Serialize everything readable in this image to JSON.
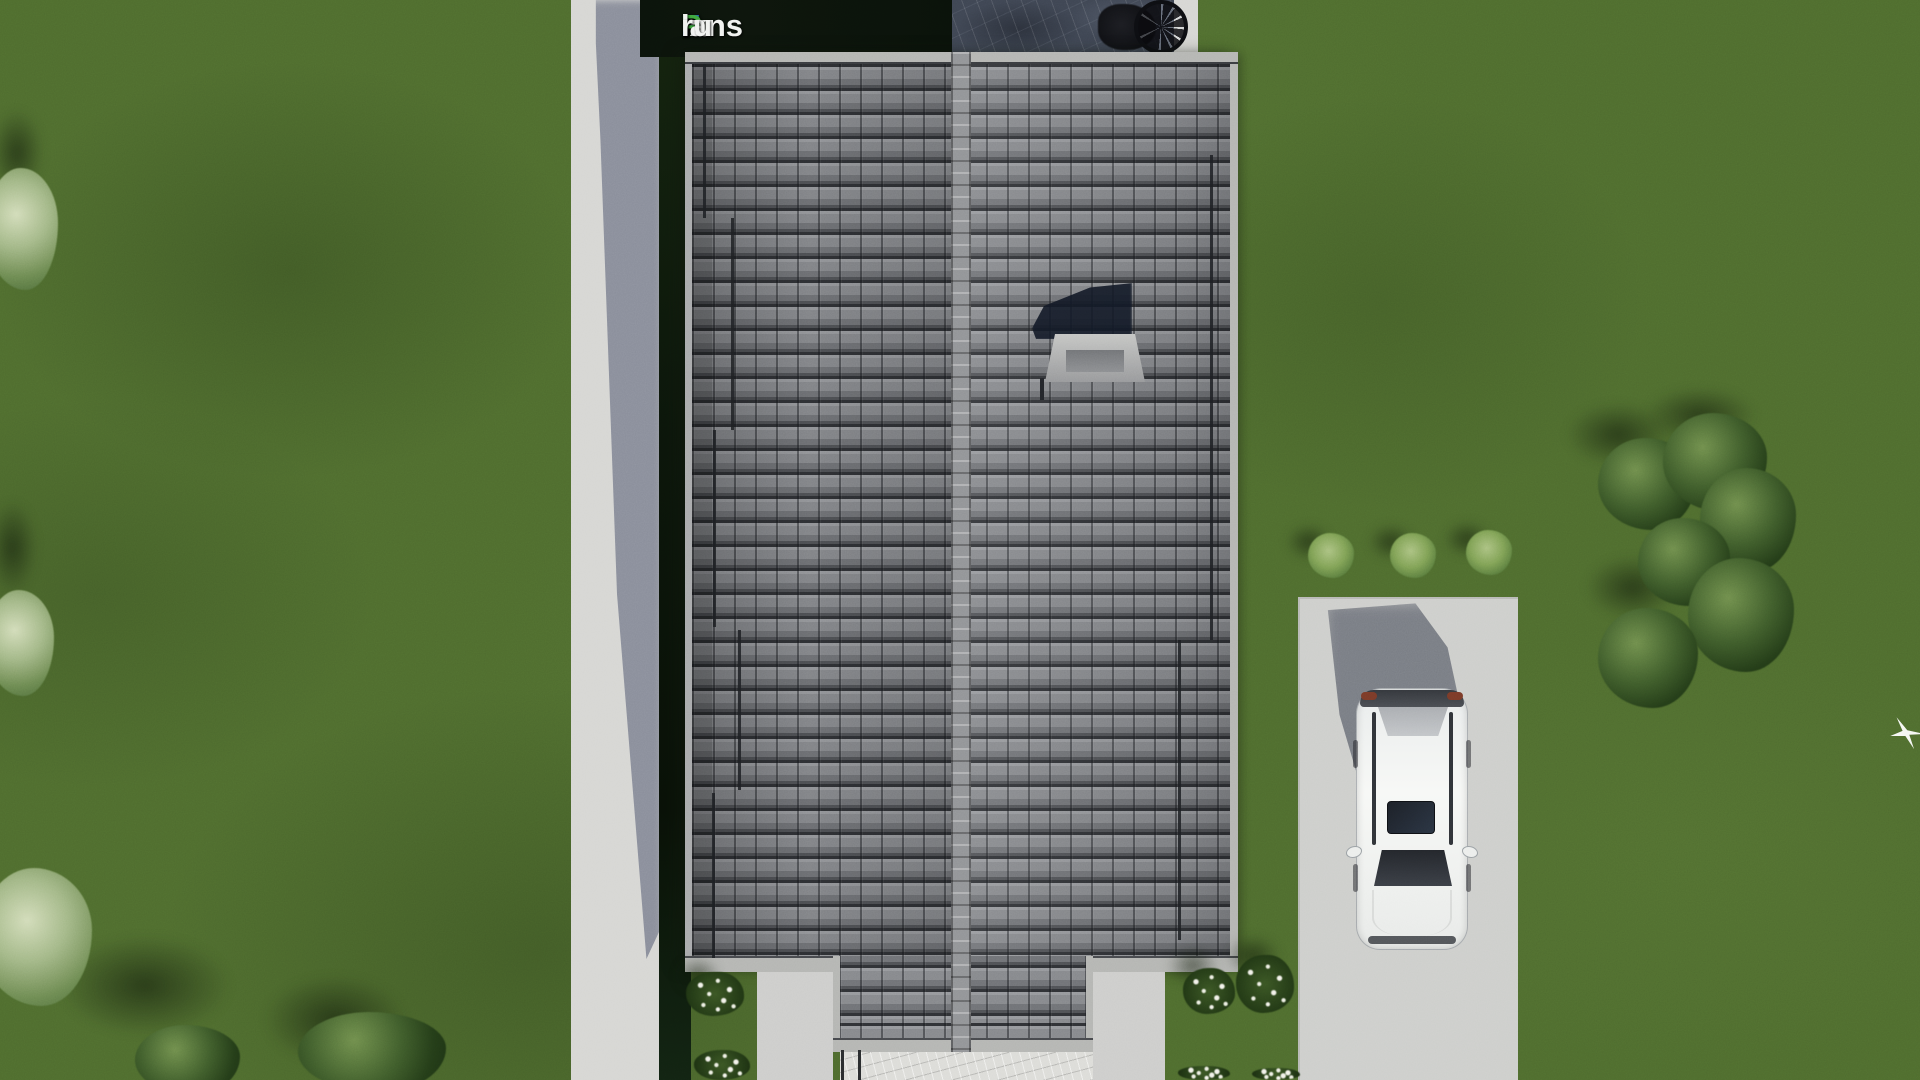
{
  "watermark": {
    "text": "FixPlans.ru",
    "segments": [
      {
        "text": "F",
        "color": "#2e6fd8"
      },
      {
        "text": "ix",
        "color": "#f1f2f0"
      },
      {
        "text": "P",
        "color": "#3da83d"
      },
      {
        "text": "lans",
        "color": "#f1f2f0"
      },
      {
        "text": ".",
        "color": "#2e6fd8"
      },
      {
        "text": "ru",
        "color": "#f1f2f0"
      }
    ]
  },
  "colors": {
    "grass": "#4e6b2e",
    "path": "#d6d6d3",
    "driveway": "#cdcecb",
    "walkway": "#dcdcd8",
    "roof_tile": "#828487",
    "roof_gap": "#2f3135",
    "roof_ridge": "#919396",
    "fascia": "#b4b5b2",
    "hedge": "#101d0e",
    "logo_bg": "#0d150c",
    "patio_stone": "#3e4552",
    "car_body": "#f2f3f1",
    "car_glass": "#272a30",
    "shadow": "#2a3142",
    "bush_dark": "#243a16",
    "bush_light": "#7fa155",
    "bush_sage": "#a9bc8b",
    "flower_white": "#f2f2ea"
  },
  "scene": {
    "view": "top-down aerial render",
    "objects": [
      "lawn",
      "sidewalk",
      "hedge",
      "stone-patio",
      "bicycle",
      "tiled-roof",
      "chimney",
      "porch-roof",
      "stone-walkway",
      "driveway",
      "car",
      "bushes",
      "flower-bushes",
      "bird"
    ]
  }
}
